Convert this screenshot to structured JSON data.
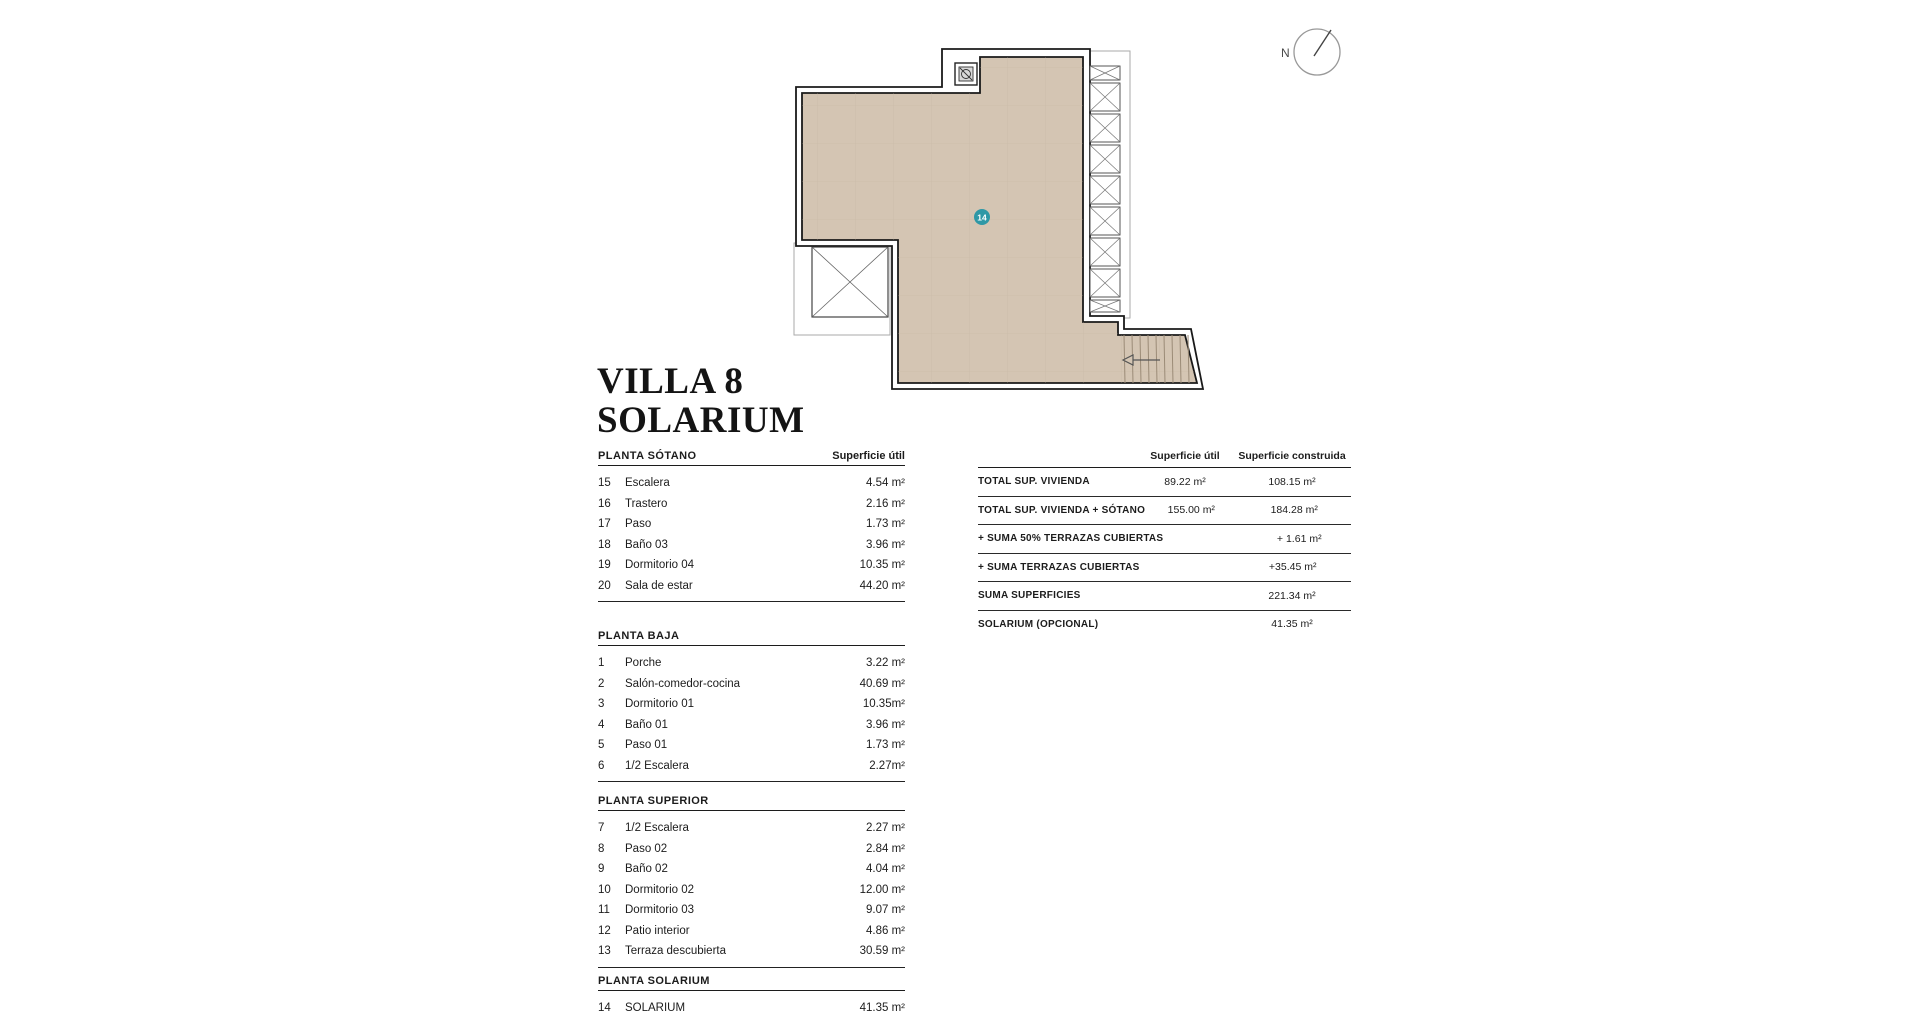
{
  "title": {
    "line1": "VILLA 8",
    "line2": "SOLARIUM"
  },
  "compass": {
    "label": "N"
  },
  "plan": {
    "room_badge": "14",
    "floor_color": "#d4c5b3",
    "grid_color": "#c3b2a0",
    "accent_color": "#2f98a6"
  },
  "left_table": {
    "superficie_util_header": "Superficie útil",
    "sections": [
      {
        "name": "PLANTA SÓTANO",
        "rows": [
          {
            "num": "15",
            "label": "Escalera",
            "value": "4.54 m²"
          },
          {
            "num": "16",
            "label": "Trastero",
            "value": "2.16 m²"
          },
          {
            "num": "17",
            "label": "Paso",
            "value": "1.73 m²"
          },
          {
            "num": "18",
            "label": "Baño 03",
            "value": "3.96 m²"
          },
          {
            "num": "19",
            "label": "Dormitorio 04",
            "value": "10.35 m²"
          },
          {
            "num": "20",
            "label": "Sala de estar",
            "value": "44.20 m²"
          }
        ]
      },
      {
        "name": "PLANTA BAJA",
        "rows": [
          {
            "num": "1",
            "label": "Porche",
            "value": "3.22 m²"
          },
          {
            "num": "2",
            "label": "Salón-comedor-cocina",
            "value": "40.69 m²"
          },
          {
            "num": "3",
            "label": "Dormitorio 01",
            "value": "10.35m²"
          },
          {
            "num": "4",
            "label": "Baño 01",
            "value": "3.96 m²"
          },
          {
            "num": "5",
            "label": "Paso 01",
            "value": "1.73 m²"
          },
          {
            "num": "6",
            "label": "1/2 Escalera",
            "value": "2.27m²"
          }
        ]
      },
      {
        "name": "PLANTA SUPERIOR",
        "rows": [
          {
            "num": "7",
            "label": "1/2 Escalera",
            "value": "2.27 m²"
          },
          {
            "num": "8",
            "label": "Paso 02",
            "value": "2.84 m²"
          },
          {
            "num": "9",
            "label": "Baño 02",
            "value": "4.04 m²"
          },
          {
            "num": "10",
            "label": "Dormitorio 02",
            "value": "12.00 m²"
          },
          {
            "num": "11",
            "label": "Dormitorio 03",
            "value": "9.07 m²"
          },
          {
            "num": "12",
            "label": "Patio interior",
            "value": "4.86 m²"
          },
          {
            "num": "13",
            "label": "Terraza descubierta",
            "value": "30.59 m²"
          }
        ]
      },
      {
        "name": "PLANTA SOLARIUM",
        "rows": [
          {
            "num": "14",
            "label": "SOLARIUM",
            "value": "41.35 m²"
          }
        ]
      }
    ]
  },
  "summary_table": {
    "col_headers": [
      "Superficie útil",
      "Superficie construida"
    ],
    "rows": [
      {
        "label": "TOTAL SUP. VIVIENDA",
        "util": "89.22 m²",
        "construida": "108.15 m²"
      },
      {
        "label": "TOTAL SUP. VIVIENDA + SÓTANO",
        "util": "155.00 m²",
        "construida": "184.28 m²"
      },
      {
        "label": "+ SUMA 50% TERRAZAS CUBIERTAS",
        "util": "",
        "construida": "+ 1.61 m²"
      },
      {
        "label": "+ SUMA TERRAZAS CUBIERTAS",
        "util": "",
        "construida": "+35.45 m²"
      },
      {
        "label": "SUMA SUPERFICIES",
        "util": "",
        "construida": "221.34 m²"
      },
      {
        "label": "SOLARIUM (OPCIONAL)",
        "util": "",
        "construida": "41.35 m²"
      }
    ]
  }
}
